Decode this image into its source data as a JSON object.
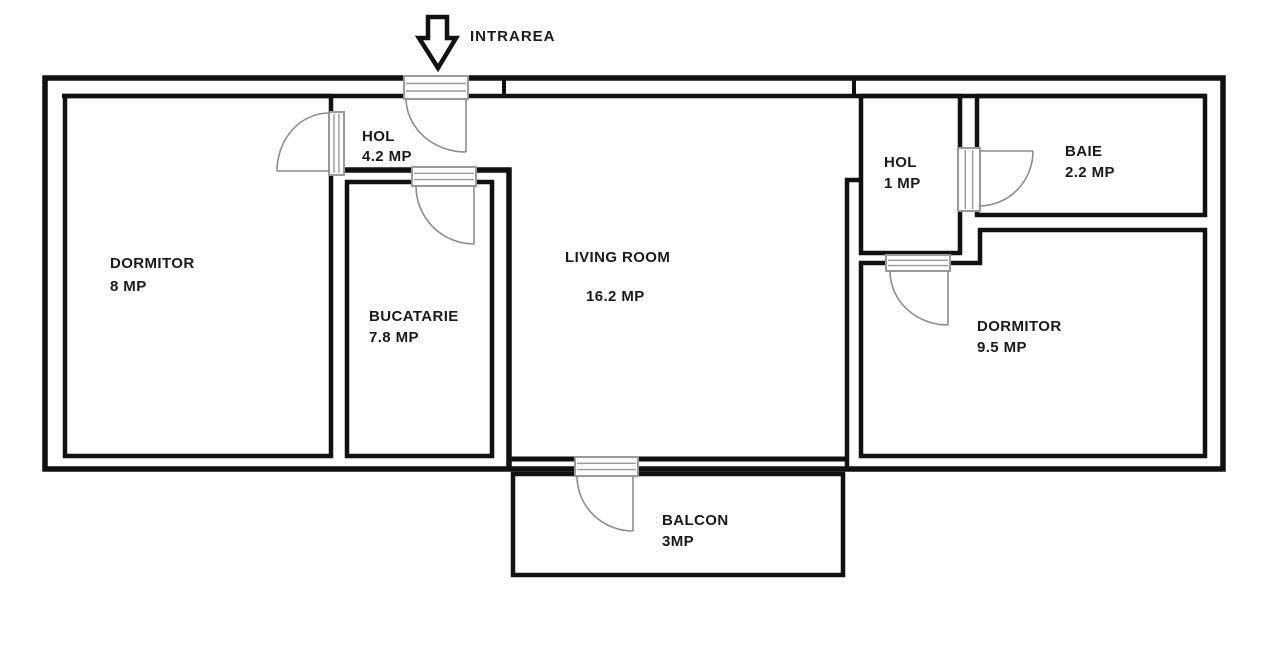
{
  "entrance": {
    "label": "INTRAREA"
  },
  "rooms": [
    {
      "id": "dormitor-left",
      "name": "DORMITOR",
      "area": "8 MP"
    },
    {
      "id": "hol-left",
      "name": "HOL",
      "area": "4.2 MP"
    },
    {
      "id": "bucatarie",
      "name": "BUCATARIE",
      "area": "7.8 MP"
    },
    {
      "id": "living-room",
      "name": "LIVING ROOM",
      "area": "16.2 MP"
    },
    {
      "id": "hol-right",
      "name": "HOL",
      "area": "1 MP"
    },
    {
      "id": "baie",
      "name": "BAIE",
      "area": "2.2 MP"
    },
    {
      "id": "dormitor-right",
      "name": "DORMITOR",
      "area": "9.5 MP"
    },
    {
      "id": "balcon",
      "name": "BALCON",
      "area": "3MP"
    }
  ],
  "colors": {
    "wall": "#111111",
    "door_frame": "#9a9a9a",
    "door_swing": "#8c8c8c",
    "label_text": "#1a1a1a",
    "background": "#ffffff"
  }
}
